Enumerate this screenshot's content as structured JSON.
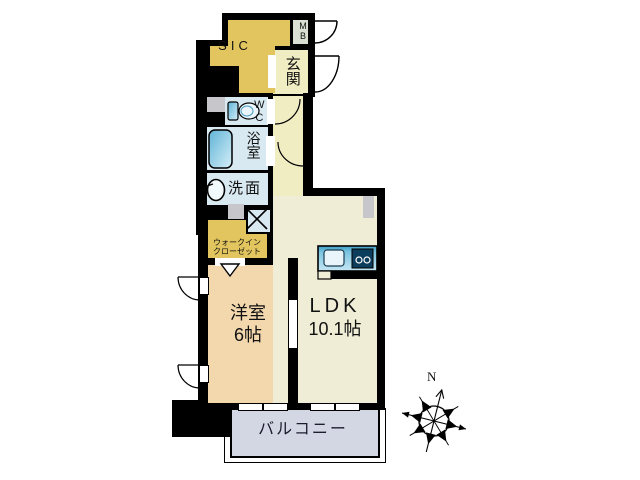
{
  "title": "apartment-floor-plan",
  "floor_plan": {
    "rooms": {
      "sic": {
        "label": "SIC"
      },
      "meter_box": {
        "label": "MB"
      },
      "entrance": {
        "label": "玄関"
      },
      "toilet": {
        "label": "WC"
      },
      "bathroom": {
        "label": "浴室"
      },
      "washroom": {
        "label": "洗面"
      },
      "walk_in_closet": {
        "label_line1": "ウォークイン",
        "label_line2": "クローゼット"
      },
      "western_room": {
        "label": "洋室",
        "size": "6帖"
      },
      "ldk": {
        "label": "LDK",
        "size": "10.1帖"
      },
      "balcony": {
        "label": "バルコニー"
      }
    },
    "compass": {
      "north_label": "N"
    },
    "colors": {
      "wall": "#000000",
      "closet_yellow": "#E2C55E",
      "entrance_cream": "#F1EDC3",
      "ldk_cream": "#EFEDD6",
      "wet_area_blue": "#D9E9F1",
      "western_room_tan": "#F3D8AE",
      "balcony_gray": "#D3D6E3",
      "pillar_gray": "#C7C7CB",
      "fixture_blue": "#5FB4D6"
    },
    "icons": {
      "compass": "compass-rose-icon",
      "toilet": "toilet-icon",
      "bathtub": "bathtub-icon",
      "sink": "sink-icon",
      "kitchen": "kitchen-counter-icon",
      "laundry": "laundry-cross-icon"
    }
  }
}
